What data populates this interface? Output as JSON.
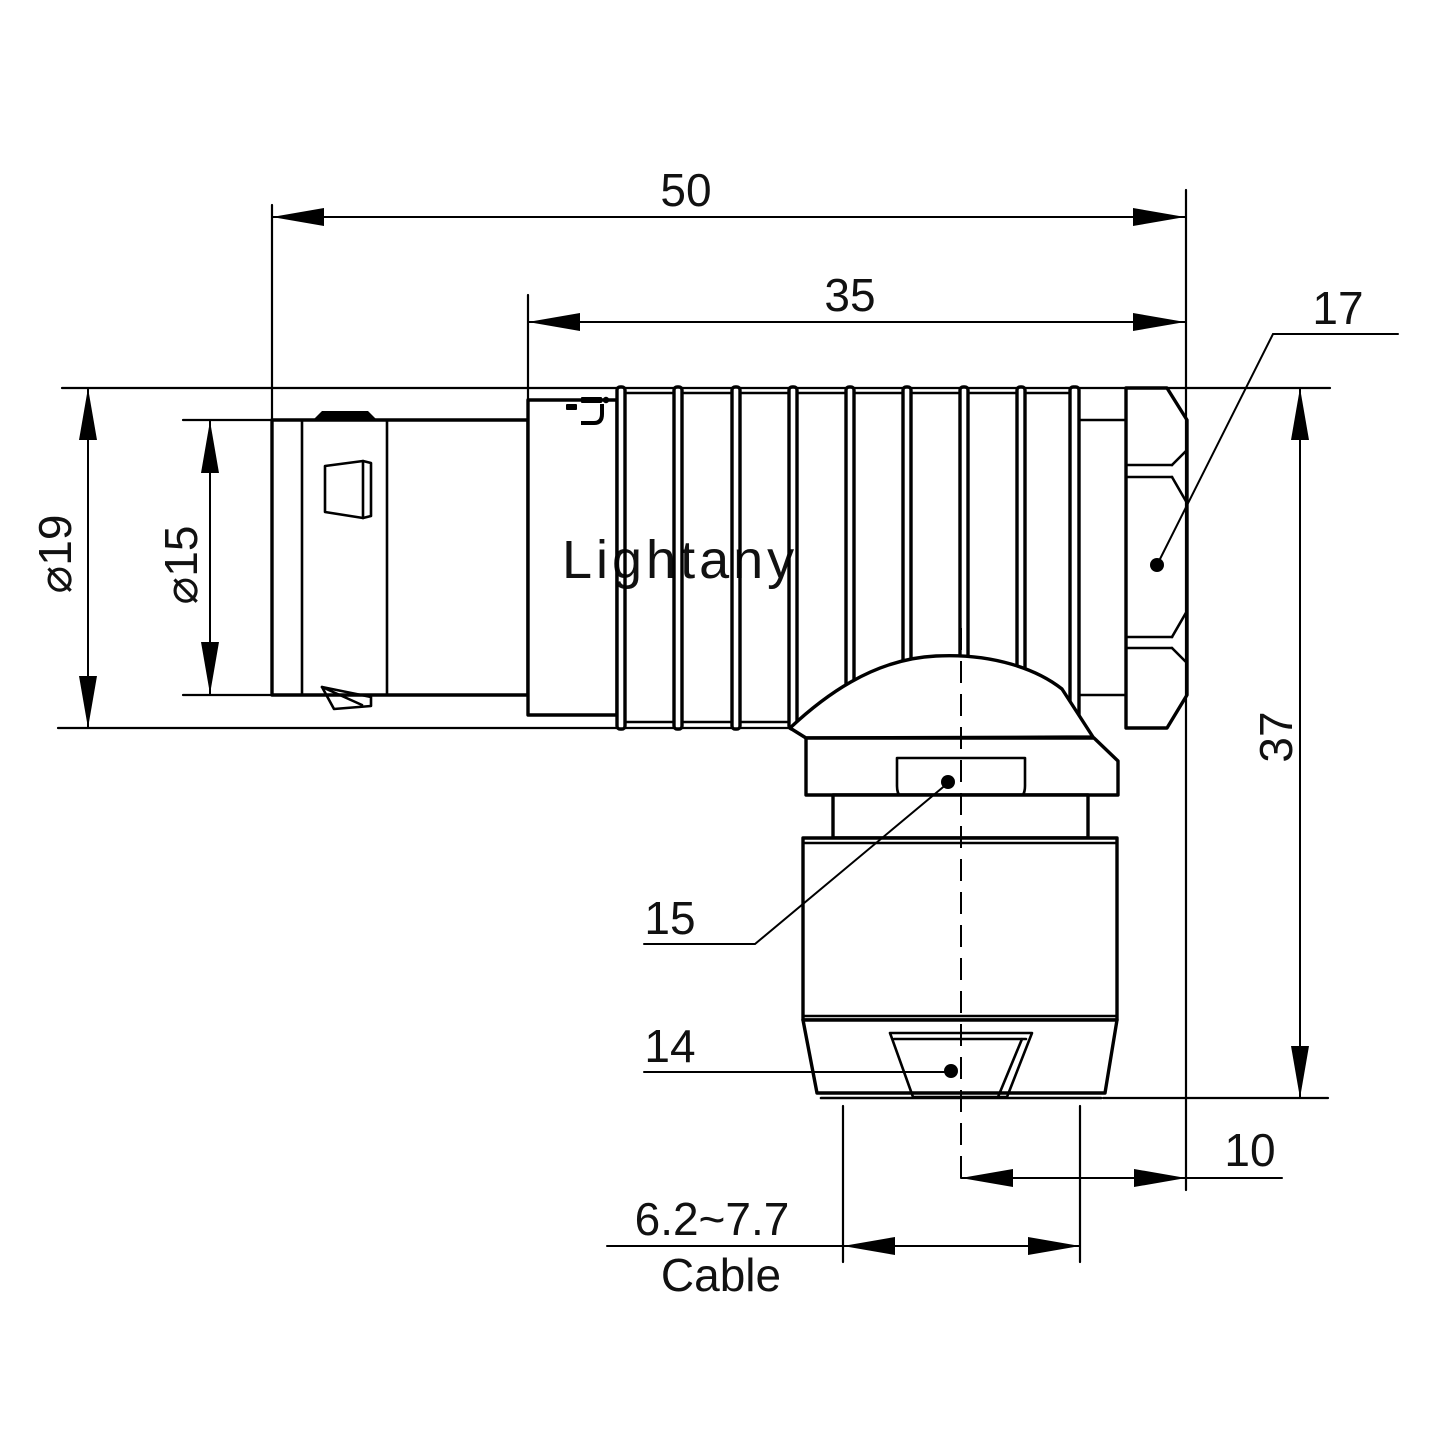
{
  "drawing": {
    "watermark_text": "Lightany",
    "watermark_color": "#f3c9c9",
    "line_color": "#000000",
    "labels": {
      "overall_length": "50",
      "body_length": "35",
      "nut_across_flats": "17",
      "outer_dia": "⌀19",
      "front_dia": "⌀15",
      "total_height": "37",
      "clamp_nut": "15",
      "tail_nut": "14",
      "axis_to_rear": "10",
      "cable_range": "6.2~7.7",
      "cable_word": "Cable"
    }
  }
}
